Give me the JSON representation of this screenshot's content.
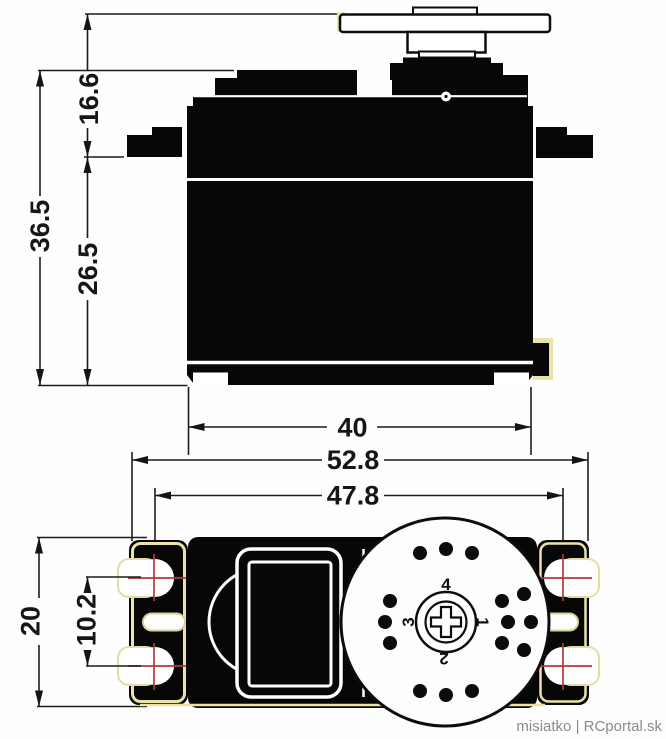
{
  "drawing": {
    "type": "servo dimension diagram",
    "watermark": "misiatko | RCportal.sk"
  },
  "colors": {
    "ink": "#1c1c1c",
    "body_fill": "#070707",
    "crosshair_red": "#b5373d",
    "tab_outline_cream": "#ebe3a8",
    "watermark_gray": "#8a8a8a",
    "background": "#ffffff"
  },
  "side_view": {
    "dims": {
      "horn_top_to_flange": "16.6",
      "overall_height": "36.5",
      "flange_to_base": "26.5",
      "case_width": "40"
    }
  },
  "top_view": {
    "dims": {
      "overall_width": "52.8",
      "mount_hole_span": "47.8",
      "case_depth": "20",
      "hole_pitch": "10.2"
    },
    "horn_marks": {
      "top": "4",
      "right": "1",
      "bottom": "2",
      "left": "3"
    }
  }
}
